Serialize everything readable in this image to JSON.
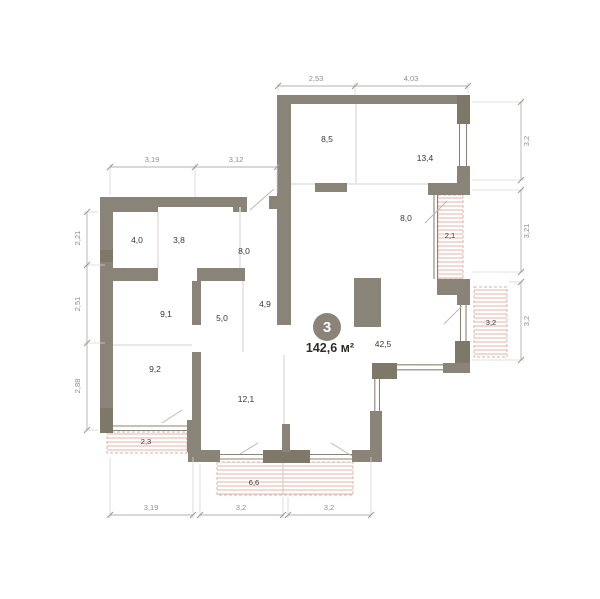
{
  "plan": {
    "badge": {
      "number": "3",
      "area": "142,6 м²"
    },
    "rooms": {
      "r85": "8,5",
      "r134": "13,4",
      "r80a": "8,0",
      "r40": "4,0",
      "r38": "3,8",
      "r80b": "8,0",
      "r49": "4,9",
      "r91": "9,1",
      "r50": "5,0",
      "r92": "9,2",
      "r121": "12,1",
      "r425": "42,5"
    },
    "balconies": {
      "b21": "2,1",
      "b32": "3,2",
      "b23": "2,3",
      "b66": "6,6"
    },
    "dims": {
      "top": [
        "2,53",
        "4,03"
      ],
      "upper_left": [
        "3,19",
        "3,12"
      ],
      "left": [
        "2,21",
        "2,51",
        "2,88"
      ],
      "right": [
        "3,2",
        "3,21",
        "3,2"
      ],
      "bottom": [
        "3,19",
        "3,2",
        "3,2"
      ]
    },
    "colors": {
      "wall": "#8a8377",
      "hatch": "#f1c7bf",
      "dimension": "#b3b1ac",
      "text": "#3a3832",
      "badge": "#8b8377"
    }
  }
}
